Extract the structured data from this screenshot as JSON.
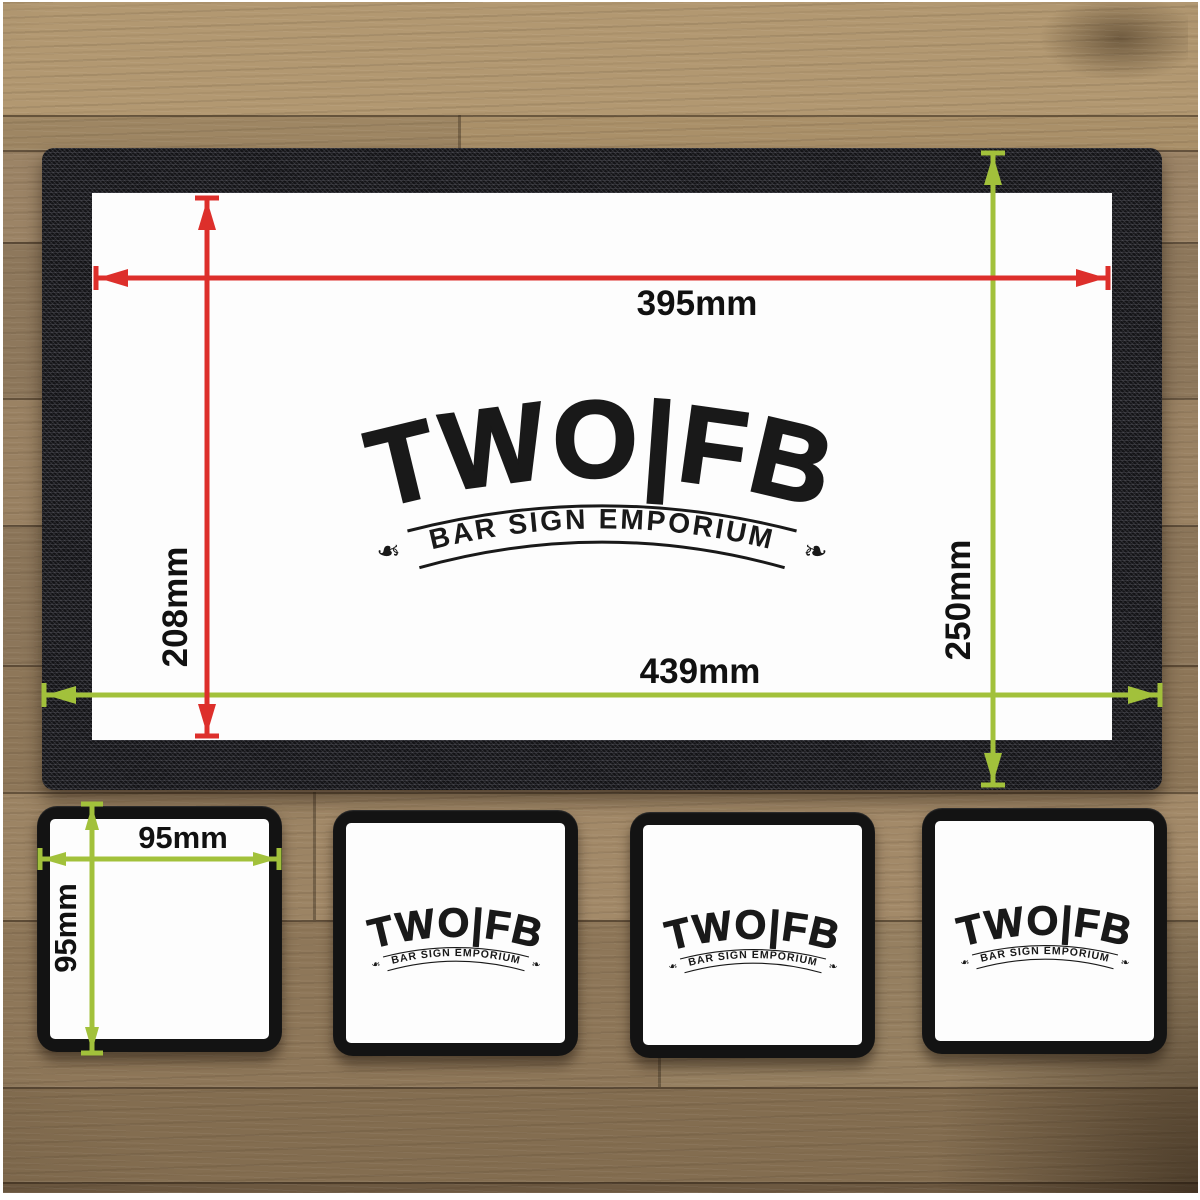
{
  "logo": {
    "main": "TWO|FB",
    "tagline": "BAR SIGN EMPORIUM"
  },
  "icons": {
    "banner_leaf_left": "❧",
    "banner_leaf_right": "❧"
  },
  "colors": {
    "inner_dimension_red": "#dd2f2b",
    "outer_dimension_green": "#a2c13b"
  },
  "mat": {
    "inner_width_label": "395mm",
    "inner_height_label": "208mm",
    "outer_width_label": "439mm",
    "outer_height_label": "250mm"
  },
  "coaster": {
    "width_label": "95mm",
    "height_label": "95mm"
  }
}
